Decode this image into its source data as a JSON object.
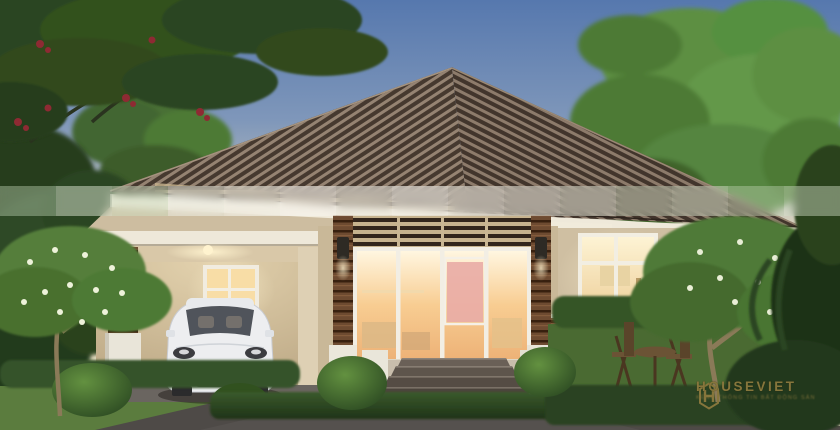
{
  "scene": {
    "type": "3d-architectural-rendering",
    "description": "Single-storey contemporary bungalow at dusk: brown ribbed hip roof, cream walls, warm-lit glass entrance doors with slatted transom, carport on the left sheltering a white hatchback, large lit window and wooden terrace furniture on the right, frangipani trees, trimmed hedges and dark driveway in front, large green trees framing both sides",
    "time_of_day": "dusk",
    "elements": [
      "sky-gradient",
      "background-trees",
      "hip-tile-roof",
      "white-fascia",
      "carport",
      "white-hatchback-car",
      "entrance-glass-doors",
      "slatted-transom",
      "tiled-columns",
      "wall-lamps",
      "right-lit-window",
      "wood-siding-wainscot",
      "front-steps",
      "pedestal-planters",
      "terrace-furniture",
      "hedges",
      "round-bushes",
      "frangipani-trees",
      "lawn",
      "driveway",
      "blurred-watermark-strip"
    ]
  },
  "colors": {
    "sky_top": "#5678ae",
    "sky_mid": "#9daec2",
    "sky_horizon": "#eee2c6",
    "roof_dark": "#46392f",
    "roof_light": "#958372",
    "fascia": "#efe9da",
    "wall": "#cfbfa2",
    "ceiling": "#e8dcc0",
    "tile_column": "#6e4b31",
    "slat_dark": "#33261c",
    "siding": "#7e5c3b",
    "glass_glow": "#f6c98e",
    "interior_pink": "#e9aca6",
    "car_white": "#edeef0",
    "steps": "#5e554c",
    "driveway": "#4e4a47",
    "lawn": "#5b7c3e",
    "hedge": "#2c4522",
    "foliage_bright": "#5d8f43",
    "foliage_dark": "#263c1f",
    "flower_red": "#8e2a33",
    "flower_white": "#eef2da",
    "lamp_glow": "#ffe9b0",
    "watermark_gold": "#86763c"
  },
  "censor_strip": {
    "blocks": [
      {
        "tint": "#c2d6b8",
        "opacity": 0.42
      },
      {
        "tint": "#dde8d4",
        "opacity": 0.5
      },
      {
        "tint": "#cfe0c4",
        "opacity": 0.45
      },
      {
        "tint": "#eef0e6",
        "opacity": 0.5
      },
      {
        "tint": "#f4f2ea",
        "opacity": 0.55
      },
      {
        "tint": "#f6f4ec",
        "opacity": 0.6
      },
      {
        "tint": "#f2f0e8",
        "opacity": 0.55
      },
      {
        "tint": "#f7f5ee",
        "opacity": 0.6
      },
      {
        "tint": "#f4f2ea",
        "opacity": 0.55
      },
      {
        "tint": "#f0efe6",
        "opacity": 0.5
      },
      {
        "tint": "#e6ebdc",
        "opacity": 0.48
      },
      {
        "tint": "#cfdec6",
        "opacity": 0.42
      },
      {
        "tint": "#dbe6d0",
        "opacity": 0.46
      },
      {
        "tint": "#c6d8ba",
        "opacity": 0.4
      },
      {
        "tint": "#d8e4cc",
        "opacity": 0.44
      }
    ]
  },
  "watermark": {
    "brand": "HOUSEVIET",
    "tagline": "KÊNH THÔNG TIN BẤT ĐỘNG SẢN",
    "color": "#86763c"
  }
}
